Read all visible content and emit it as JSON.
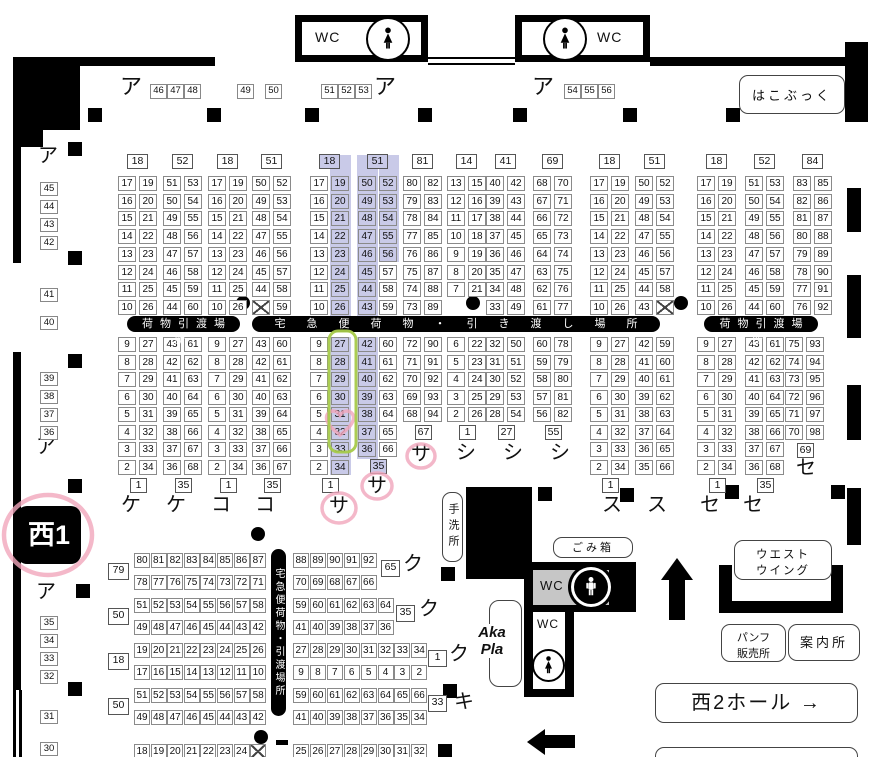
{
  "hall": {
    "badge": "西1"
  },
  "kana": {
    "a": "ア"
  },
  "top_row": {
    "g1": [
      "46",
      "47",
      "48"
    ],
    "g49": "49",
    "g50": "50",
    "g2": [
      "51",
      "52",
      "53"
    ],
    "g3": [
      "54",
      "55",
      "56"
    ]
  },
  "left_edge": {
    "groups": [
      [
        "45",
        "44",
        "43",
        "42"
      ],
      [
        "41"
      ],
      [
        "40"
      ],
      [
        "39",
        "38",
        "37",
        "36"
      ],
      [
        "35",
        "34",
        "33",
        "32"
      ],
      [
        "31"
      ],
      [
        "30"
      ]
    ]
  },
  "bars": {
    "left": "荷物引渡場所",
    "center": "宅急便荷物・引き渡し場所",
    "right": "荷物引渡場所",
    "vertical": "宅急便荷物・引渡場所"
  },
  "facilities": {
    "wc": "WC",
    "hakobook": "はこぶっく",
    "tearai": "手洗所",
    "gomibako": "ごみ箱",
    "west_wing_l1": "ウエスト",
    "west_wing_l2": "ウイング",
    "pamph_l1": "パンフ",
    "pamph_l2": "販売所",
    "annai": "案内所",
    "nishi2_label": "西2ホール",
    "nishi2_arrow": "→",
    "akapla_l1": "Aka",
    "akapla_l2": "Pla"
  },
  "upper_blocks": [
    {
      "header": "18",
      "left": [
        "17",
        "16",
        "15",
        "14",
        "13",
        "12",
        "11",
        "10"
      ],
      "right": [
        "19",
        "20",
        "21",
        "22",
        "23",
        "24",
        "25",
        "26"
      ]
    },
    {
      "header": "52",
      "left": [
        "51",
        "50",
        "49",
        "48",
        "47",
        "46",
        "45",
        "44"
      ],
      "right": [
        "53",
        "54",
        "55",
        "56",
        "57",
        "58",
        "59",
        "60"
      ]
    },
    {
      "header": "18",
      "left": [
        "17",
        "16",
        "15",
        "14",
        "13",
        "12",
        "11",
        "10"
      ],
      "right": [
        "19",
        "20",
        "21",
        "22",
        "23",
        "24",
        "25",
        "26"
      ]
    },
    {
      "header": "51",
      "left": [
        "50",
        "49",
        "48",
        "47",
        "46",
        "45",
        "44",
        "X"
      ],
      "right": [
        "52",
        "53",
        "54",
        "55",
        "56",
        "57",
        "58",
        "59"
      ],
      "dot": "left"
    },
    {
      "header": "18",
      "left": [
        "17",
        "16",
        "15",
        "14",
        "13",
        "12",
        "11",
        "10"
      ],
      "right": [
        "19",
        "20",
        "21",
        "22",
        "23",
        "24",
        "25",
        "26"
      ],
      "hl": {
        "header": true,
        "right": 8
      }
    },
    {
      "header": "51",
      "left": [
        "50",
        "49",
        "48",
        "47",
        "46",
        "45",
        "44",
        "43"
      ],
      "right": [
        "52",
        "53",
        "54",
        "55",
        "56",
        "57",
        "58",
        "59"
      ],
      "hl": {
        "header": true,
        "left": 8,
        "right": 5
      }
    },
    {
      "header": "81",
      "left": [
        "80",
        "79",
        "78",
        "77",
        "76",
        "75",
        "74",
        "73"
      ],
      "right": [
        "82",
        "83",
        "84",
        "85",
        "86",
        "87",
        "88",
        "89"
      ]
    },
    {
      "header": "14",
      "left": [
        "13",
        "12",
        "11",
        "10",
        "9",
        "8",
        "7"
      ],
      "right": [
        "15",
        "16",
        "17",
        "18",
        "19",
        "20",
        "21"
      ],
      "dot": "center"
    },
    {
      "header": "41",
      "left": [
        "40",
        "39",
        "38",
        "37",
        "36",
        "35",
        "34",
        "33"
      ],
      "right": [
        "42",
        "43",
        "44",
        "45",
        "46",
        "47",
        "48",
        "49"
      ]
    },
    {
      "header": "69",
      "left": [
        "68",
        "67",
        "66",
        "65",
        "64",
        "63",
        "62",
        "61"
      ],
      "right": [
        "70",
        "71",
        "72",
        "73",
        "74",
        "75",
        "76",
        "77"
      ]
    },
    {
      "header": "18",
      "left": [
        "17",
        "16",
        "15",
        "14",
        "13",
        "12",
        "11",
        "10"
      ],
      "right": [
        "19",
        "20",
        "21",
        "22",
        "23",
        "24",
        "25",
        "26"
      ]
    },
    {
      "header": "51",
      "left": [
        "50",
        "49",
        "48",
        "47",
        "46",
        "45",
        "44",
        "43"
      ],
      "right": [
        "52",
        "53",
        "54",
        "55",
        "56",
        "57",
        "58",
        "X"
      ],
      "dot": "right"
    },
    {
      "header": "18",
      "left": [
        "17",
        "16",
        "15",
        "14",
        "13",
        "12",
        "11",
        "10"
      ],
      "right": [
        "19",
        "20",
        "21",
        "22",
        "23",
        "24",
        "25",
        "26"
      ]
    },
    {
      "header": "52",
      "left": [
        "51",
        "50",
        "49",
        "48",
        "47",
        "46",
        "45",
        "44"
      ],
      "right": [
        "53",
        "54",
        "55",
        "56",
        "57",
        "58",
        "59",
        "60"
      ]
    },
    {
      "header": "84",
      "left": [
        "83",
        "82",
        "81",
        "80",
        "79",
        "78",
        "77",
        "76"
      ],
      "right": [
        "85",
        "86",
        "87",
        "88",
        "89",
        "90",
        "91",
        "92"
      ]
    }
  ],
  "mid_blocks": [
    {
      "left": [
        "9",
        "8",
        "7",
        "6",
        "5",
        "4",
        "3",
        "2"
      ],
      "right": [
        "27",
        "28",
        "29",
        "30",
        "31",
        "32",
        "33",
        "34"
      ],
      "footer": "1",
      "label": "ケ"
    },
    {
      "left": [
        "43",
        "42",
        "41",
        "40",
        "39",
        "38",
        "37",
        "36"
      ],
      "right": [
        "61",
        "62",
        "63",
        "64",
        "65",
        "66",
        "67",
        "68"
      ],
      "footer": "35",
      "label": "ケ"
    },
    {
      "left": [
        "9",
        "8",
        "7",
        "6",
        "5",
        "4",
        "3",
        "2"
      ],
      "right": [
        "27",
        "28",
        "29",
        "30",
        "31",
        "32",
        "33",
        "34"
      ],
      "footer": "1",
      "label": "コ"
    },
    {
      "left": [
        "43",
        "42",
        "41",
        "40",
        "39",
        "38",
        "37",
        "36"
      ],
      "right": [
        "60",
        "61",
        "62",
        "63",
        "64",
        "65",
        "66",
        "67"
      ],
      "footer": "35",
      "label": "コ"
    },
    {
      "left": [
        "9",
        "8",
        "7",
        "6",
        "5",
        "4",
        "3",
        "2"
      ],
      "right": [
        "27",
        "28",
        "29",
        "30",
        "31",
        "32",
        "33",
        "34"
      ],
      "footer": "1",
      "label": "サ",
      "hl": {
        "right": 8
      },
      "circled": true
    },
    {
      "left": [
        "42",
        "41",
        "40",
        "39",
        "38",
        "37",
        "36"
      ],
      "right": [
        "60",
        "61",
        "62",
        "63",
        "64",
        "65",
        "66"
      ],
      "footer": "35",
      "label": "サ",
      "hl": {
        "left": 7,
        "footer": true
      },
      "circled": true
    },
    {
      "left": [
        "72",
        "71",
        "70",
        "69",
        "68"
      ],
      "right": [
        "90",
        "91",
        "92",
        "93",
        "94"
      ],
      "footer": "67",
      "label": "サ",
      "circled": true
    },
    {
      "left": [
        "6",
        "5",
        "4",
        "3",
        "2"
      ],
      "right": [
        "22",
        "23",
        "24",
        "25",
        "26"
      ],
      "footer": "1",
      "label": "シ"
    },
    {
      "left": [
        "32",
        "31",
        "30",
        "29",
        "28"
      ],
      "right": [
        "50",
        "51",
        "52",
        "53",
        "54"
      ],
      "footer": "27",
      "label": "シ"
    },
    {
      "left": [
        "60",
        "59",
        "58",
        "57",
        "56"
      ],
      "right": [
        "78",
        "79",
        "80",
        "81",
        "82"
      ],
      "footer": "55",
      "label": "シ"
    },
    {
      "left": [
        "9",
        "8",
        "7",
        "6",
        "5",
        "4",
        "3",
        "2"
      ],
      "right": [
        "27",
        "28",
        "29",
        "30",
        "31",
        "32",
        "33",
        "34"
      ],
      "footer": "1",
      "label": "ス"
    },
    {
      "left": [
        "42",
        "41",
        "40",
        "39",
        "38",
        "37",
        "36",
        "35"
      ],
      "right": [
        "59",
        "60",
        "61",
        "62",
        "63",
        "64",
        "65",
        "66"
      ],
      "label": "ス"
    },
    {
      "left": [
        "9",
        "8",
        "7",
        "6",
        "5",
        "4",
        "3",
        "2"
      ],
      "right": [
        "27",
        "28",
        "29",
        "30",
        "31",
        "32",
        "33",
        "34"
      ],
      "footer": "1",
      "label": "セ"
    },
    {
      "left": [
        "43",
        "42",
        "41",
        "40",
        "39",
        "38",
        "37",
        "36"
      ],
      "right": [
        "61",
        "62",
        "63",
        "64",
        "65",
        "66",
        "67",
        "68"
      ],
      "footer": "35",
      "label": "セ"
    },
    {
      "left": [
        "75",
        "74",
        "73",
        "72",
        "71",
        "70"
      ],
      "right": [
        "93",
        "94",
        "95",
        "96",
        "97",
        "98"
      ],
      "footer": "69",
      "label": "セ"
    }
  ],
  "bottom_left_bands": [
    {
      "header": "79",
      "row1": [
        "80",
        "81",
        "82",
        "83",
        "84",
        "85",
        "86",
        "87"
      ],
      "row2": [
        "78",
        "77",
        "76",
        "75",
        "74",
        "73",
        "72",
        "71"
      ]
    },
    {
      "header": "50",
      "row1": [
        "51",
        "52",
        "53",
        "54",
        "55",
        "56",
        "57",
        "58"
      ],
      "row2": [
        "49",
        "48",
        "47",
        "46",
        "45",
        "44",
        "43",
        "42"
      ]
    },
    {
      "header": "18",
      "row1": [
        "19",
        "20",
        "21",
        "22",
        "23",
        "24",
        "25",
        "26"
      ],
      "row2": [
        "17",
        "16",
        "15",
        "14",
        "13",
        "12",
        "11",
        "10"
      ]
    },
    {
      "header": "50",
      "row1": [
        "51",
        "52",
        "53",
        "54",
        "55",
        "56",
        "57",
        "58"
      ],
      "row2": [
        "49",
        "48",
        "47",
        "46",
        "45",
        "44",
        "43",
        "42"
      ]
    },
    {
      "header": "",
      "row1": [
        "18",
        "19",
        "20",
        "21",
        "22",
        "23",
        "24",
        "X"
      ],
      "row2": []
    }
  ],
  "bottom_right_bands": [
    {
      "row1": [
        "88",
        "89",
        "90",
        "91",
        "92"
      ],
      "row2": [
        "70",
        "69",
        "68",
        "67",
        "66"
      ],
      "header": "65",
      "label": "ク"
    },
    {
      "row1": [
        "59",
        "60",
        "61",
        "62",
        "63",
        "64"
      ],
      "row2": [
        "41",
        "40",
        "39",
        "38",
        "37",
        "36"
      ],
      "header": "35",
      "label": "ク"
    },
    {
      "row1": [
        "27",
        "28",
        "29",
        "30",
        "31",
        "32",
        "33",
        "34"
      ],
      "row2": [
        "9",
        "8",
        "7",
        "6",
        "5",
        "4",
        "3",
        "2"
      ],
      "header": "1",
      "label": "ク"
    },
    {
      "row1": [
        "59",
        "60",
        "61",
        "62",
        "63",
        "64",
        "65",
        "66"
      ],
      "row2": [
        "41",
        "40",
        "39",
        "38",
        "37",
        "36",
        "35",
        "34"
      ],
      "header": "33",
      "label": "キ"
    },
    {
      "row1": [
        "25",
        "26",
        "27",
        "28",
        "29",
        "30",
        "31",
        "32"
      ],
      "row2": [],
      "header": "",
      "label": ""
    }
  ],
  "annotations": {
    "highlight_color": "#c9cae8",
    "pink_color": "#f1a6bc",
    "green_color": "#a6ca4a",
    "circled_labels": [
      "西1",
      "サ",
      "サ",
      "サ"
    ],
    "heart_cell": "32",
    "green_boxed_cells": "27-33"
  }
}
